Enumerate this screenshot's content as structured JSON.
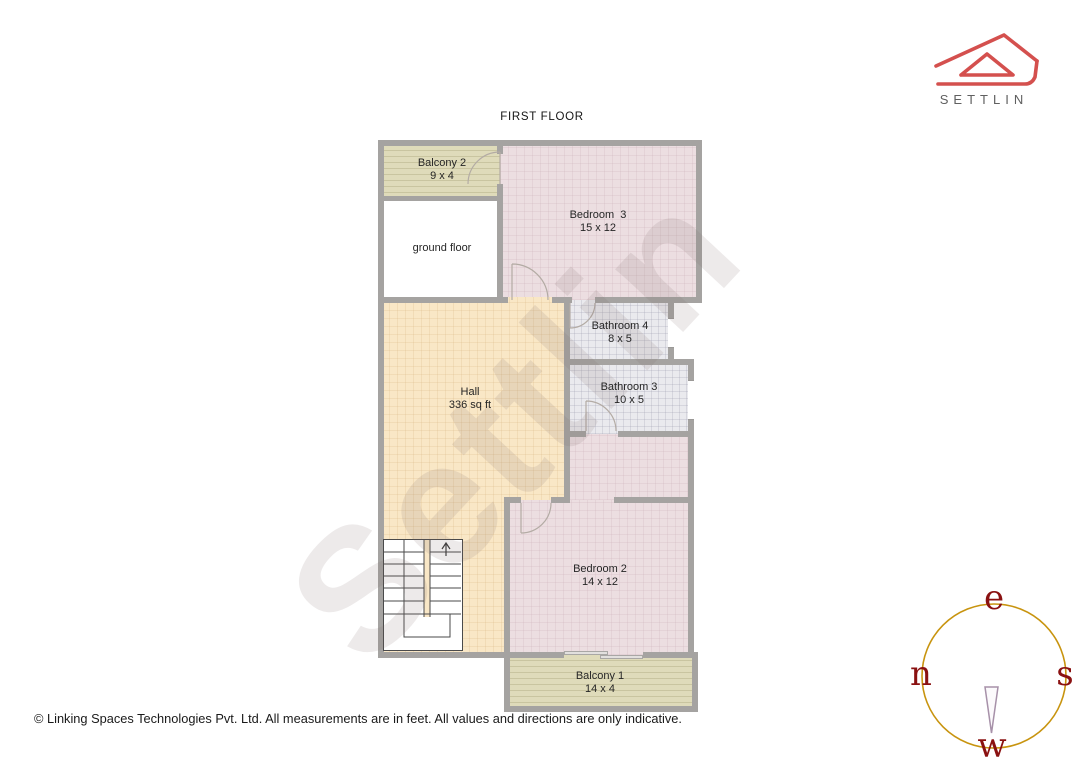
{
  "page": {
    "title": "FIRST FLOOR",
    "watermark": "Settlin",
    "footer": "© Linking Spaces Technologies Pvt. Ltd. All measurements are in feet. All values and directions are only indicative."
  },
  "brand": {
    "name": "SETTLIN",
    "logo_color": "#d4504e",
    "text_color": "#606060"
  },
  "rooms": {
    "balcony2": {
      "label": "Balcony 2",
      "dims": "9 x 4"
    },
    "ground_floor": {
      "label": "ground floor",
      "dims": ""
    },
    "bedroom3": {
      "label": "Bedroom  3",
      "dims": "15 x 12"
    },
    "bathroom4": {
      "label": "Bathroom 4",
      "dims": "8 x 5"
    },
    "bathroom3": {
      "label": "Bathroom 3",
      "dims": "10 x 5"
    },
    "hall": {
      "label": "Hall",
      "dims": "336 sq ft"
    },
    "bedroom2": {
      "label": "Bedroom 2",
      "dims": "14 x 12"
    },
    "balcony1": {
      "label": "Balcony 1",
      "dims": "14 x 4"
    }
  },
  "compass": {
    "top": "e",
    "left": "n",
    "right": "s",
    "bottom": "w",
    "ring_color": "#c8940f",
    "letter_color": "#8a1111"
  },
  "colors": {
    "wall": "#a5a3a1",
    "bedroom_fill": "#ecdee1",
    "hall_fill": "#f9e7c6",
    "bathroom_fill": "#eaeaee",
    "balcony_fill": "#dfdbba"
  }
}
